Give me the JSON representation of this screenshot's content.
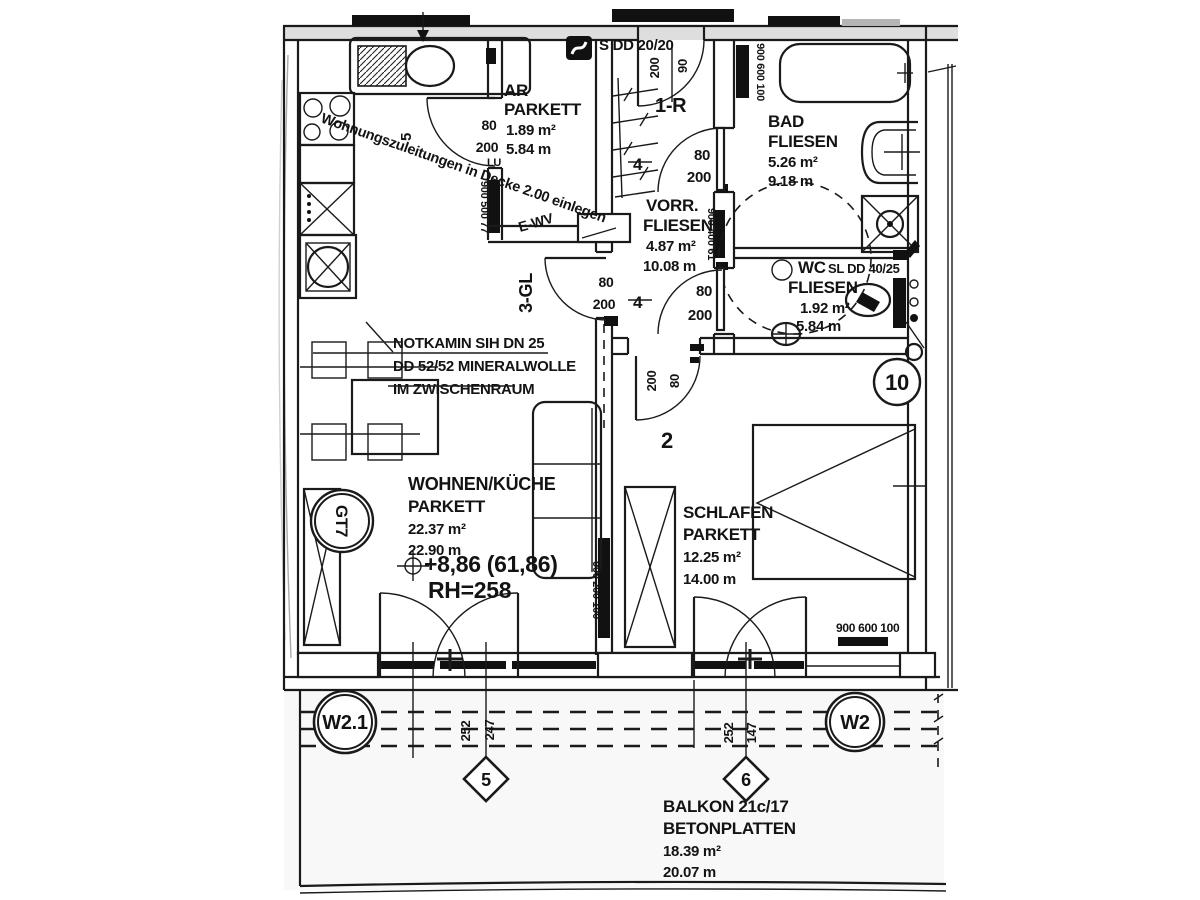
{
  "rooms": {
    "ar": {
      "name": "AR",
      "floor": "PARKETT",
      "area": "1.89 m²",
      "girth": "5.84 m"
    },
    "bad": {
      "name": "BAD",
      "floor": "FLIESEN",
      "area": "5.26 m²",
      "girth": "9.18 m"
    },
    "vorraum": {
      "name": "VORR.",
      "floor": "FLIESEN",
      "area": "4.87 m²",
      "girth": "10.08 m"
    },
    "wc": {
      "name": "WC",
      "floor": "FLIESEN",
      "area": "1.92 m²",
      "girth": "5.84 m"
    },
    "wohnen": {
      "name": "WOHNEN/KÜCHE",
      "floor": "PARKETT",
      "area": "22.37 m²",
      "girth": "22.90 m"
    },
    "schlafen": {
      "name": "SCHLAFEN",
      "floor": "PARKETT",
      "area": "12.25 m²",
      "girth": "14.00 m"
    },
    "balkon": {
      "name": "BALKON 21c/17",
      "floor": "BETONPLATTEN",
      "area": "18.39 m²",
      "girth": "20.07 m"
    }
  },
  "notes": {
    "supply": "Wohnungszuleitungen in Decke 2.00 einlegen",
    "notkamin1": "NOTKAMIN SIH DN 25",
    "notkamin2": "DD 52/52 MINERALWOLLE",
    "notkamin3": "IM ZWISCHENRAUM",
    "level": "+8,86 (61,86)",
    "room_height": "RH=258",
    "s_dd": "S DD 20/20",
    "sl_dd": "SL DD 40/25",
    "e_wv": "E-WV",
    "lu": "LU"
  },
  "doors": {
    "entry": {
      "no": "1-R",
      "w": "90",
      "h": "200"
    },
    "schlafen": {
      "no": "2",
      "w": "80",
      "h": "200"
    },
    "wohnen": {
      "no": "3-GL",
      "w": "80",
      "h": "200"
    },
    "bad": {
      "no": "4",
      "w": "80",
      "h": "200"
    },
    "wc": {
      "no": "4",
      "w": "80",
      "h": "200"
    },
    "ar": {
      "no": "5",
      "w": "80",
      "h": "200"
    }
  },
  "windows": {
    "bad": "900 600 100",
    "vorraum": "900 400 61",
    "ar": "900 500 77",
    "wohnen_wall": "900 200 100",
    "schlafen": "900 600 100"
  },
  "axes": {
    "w21": "W2.1",
    "w2": "W2",
    "a5": "5",
    "a6": "6",
    "gt7": "GT7",
    "unit": "10",
    "dim_252a": "252",
    "dim_247": "247",
    "dim_252b": "252",
    "dim_147": "147"
  }
}
